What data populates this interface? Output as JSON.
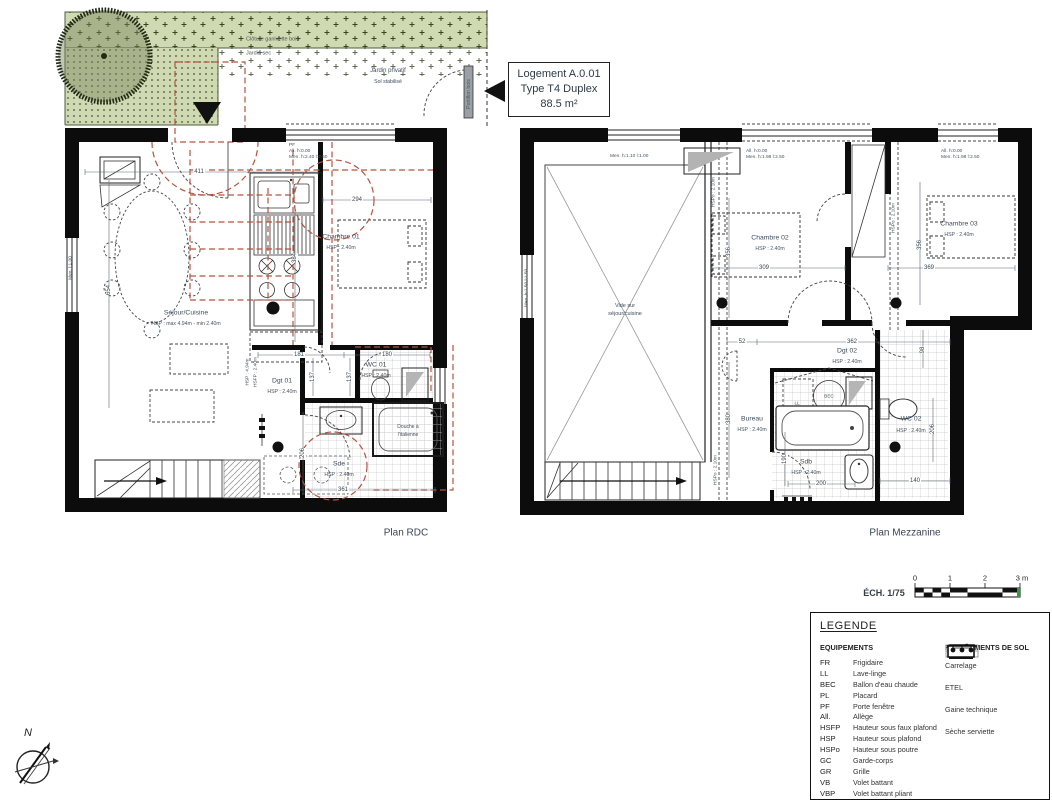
{
  "title_block": {
    "line1": "Logement A.0.01",
    "line2": "Type T4 Duplex",
    "line3": "88.5 m²"
  },
  "garden": {
    "cloture": "Clôture ganivette bois",
    "jardin_sec": "Jardin sec",
    "jardin_privatif": "Jardin privatif",
    "sol_stabilise": "Sol stabilisé",
    "portillon": "Portillon bois"
  },
  "plans": {
    "rdc": {
      "title": "Plan RDC",
      "rooms": {
        "sejour": {
          "name": "Séjour/Cuisine",
          "hsp": "HSP : max 4.94m - min 2.40m"
        },
        "chambre01": {
          "name": "Chambre 01",
          "hsp": "HSP : 2.40m"
        },
        "dgt01": {
          "name": "Dgt 01",
          "hsp": "HSP : 2.40m"
        },
        "wc01": {
          "name": "WC 01",
          "hsp": "HSP : 2.40m"
        },
        "sde": {
          "name": "Sde",
          "hsp": "HSP : 2.40m"
        },
        "douche": {
          "line1": "Douche à",
          "line2": "l'italienne"
        }
      },
      "dims": {
        "d411": "411",
        "d294": "294",
        "d654": "654",
        "d384": "384",
        "d181": "181",
        "d180": "180",
        "d137a": "137",
        "d137b": "137",
        "d206": "206",
        "d361": "361"
      },
      "notes": {
        "pf": "PF",
        "window_top_1": "All. h:0.00",
        "window_top_2": "Men. h:2.40 l:2.50",
        "left_window": "Men. l:1.00",
        "hsp_vert": "HSP : 4.94m",
        "hsfp_vert": "HSFP : 2.40m"
      }
    },
    "mezzanine": {
      "title": "Plan Mezzanine",
      "void": {
        "line1": "Vide sur",
        "line2": "séjour/cuisine"
      },
      "rooms": {
        "chambre02": {
          "name": "Chambre 02",
          "hsp": "HSP : 2.40m"
        },
        "chambre03": {
          "name": "Chambre 03",
          "hsp": "HSP : 2.40m"
        },
        "dgt02": {
          "name": "Dgt 02",
          "hsp": "HSP : 2.40m"
        },
        "bureau": {
          "name": "Bureau",
          "hsp": "HSP : 2.40m"
        },
        "sdb": {
          "name": "Sdb",
          "hsp": "HSP : 2.40m"
        },
        "wc02": {
          "name": "WC 02",
          "hsp": "HSP : 2.40m"
        }
      },
      "equip": {
        "bec": "BEC",
        "ll": "LL"
      },
      "dims": {
        "d309": "309",
        "d369": "369",
        "d356a": "356",
        "d356b": "356",
        "d52": "52",
        "d362": "362",
        "d98": "98",
        "d380": "380",
        "d190": "190",
        "d200": "200",
        "d140": "140",
        "d206": "206"
      },
      "notes": {
        "win1": "Men. h:1.10 l:1.00",
        "win2a": "All. h:0.00",
        "win2b": "Men. h:1.98 l:2.50",
        "win3a": "All. h:0.00",
        "win3b": "Men. h:1.98 l:2.50",
        "hspo": "HSPo : 2.10m",
        "left_window": "Men. h:1.50 l:1.50"
      }
    }
  },
  "scale": {
    "label": "ÉCH. 1/75",
    "tick0": "0",
    "tick1": "1",
    "tick2": "2",
    "tick3": "3 m"
  },
  "legend": {
    "title": "LEGENDE",
    "equipment_title": "EQUIPEMENTS",
    "flooring_title": "REVETEMENTS DE SOL",
    "equipment": [
      {
        "abbr": "FR",
        "label": "Frigidaire"
      },
      {
        "abbr": "LL",
        "label": "Lave-linge"
      },
      {
        "abbr": "BEC",
        "label": "Ballon d'eau chaude"
      },
      {
        "abbr": "PL",
        "label": "Placard"
      },
      {
        "abbr": "PF",
        "label": "Porte fenêtre"
      },
      {
        "abbr": "All.",
        "label": "Allège"
      },
      {
        "abbr": "HSFP",
        "label": "Hauteur sous faux plafond"
      },
      {
        "abbr": "HSP",
        "label": "Hauteur sous plafond"
      },
      {
        "abbr": "HSPo",
        "label": "Hauteur sous poutre"
      },
      {
        "abbr": "GC",
        "label": "Garde-corps"
      },
      {
        "abbr": "GR",
        "label": "Grille"
      },
      {
        "abbr": "VB",
        "label": "Volet battant"
      },
      {
        "abbr": "VBP",
        "label": "Volet battant pliant"
      }
    ],
    "flooring": [
      {
        "label": "Carrelage"
      },
      {
        "label": "ETEL"
      },
      {
        "label": "Gaine technique"
      },
      {
        "label": "Sèche serviette"
      }
    ]
  },
  "compass": {
    "north": "N"
  },
  "colors": {
    "red_dash": "#b4543e",
    "garden_green": "#cfd9b2",
    "wall_black": "#0c0c0c",
    "scale_green": "#2e9e43"
  }
}
